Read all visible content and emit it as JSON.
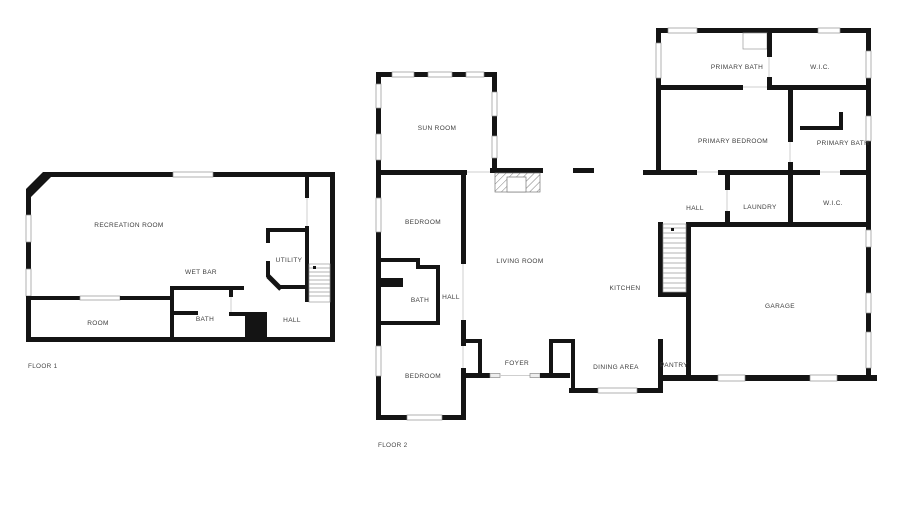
{
  "title": "Two floor residential floor plan",
  "colors": {
    "wall": "#141414",
    "label_text": "#3d3d3d",
    "background": "#ffffff"
  },
  "floors": [
    {
      "label": "FLOOR 1",
      "rooms": [
        {
          "name": "RECREATION ROOM"
        },
        {
          "name": "WET BAR"
        },
        {
          "name": "UTILITY"
        },
        {
          "name": "ROOM"
        },
        {
          "name": "BATH"
        },
        {
          "name": "HALL"
        }
      ]
    },
    {
      "label": "FLOOR 2",
      "rooms": [
        {
          "name": "SUN ROOM"
        },
        {
          "name": "BEDROOM"
        },
        {
          "name": "LIVING ROOM"
        },
        {
          "name": "BATH"
        },
        {
          "name": "HALL"
        },
        {
          "name": "BEDROOM"
        },
        {
          "name": "FOYER"
        },
        {
          "name": "KITCHEN"
        },
        {
          "name": "DINING AREA"
        },
        {
          "name": "PANTRY"
        },
        {
          "name": "HALL"
        },
        {
          "name": "LAUNDRY"
        },
        {
          "name": "W.I.C."
        },
        {
          "name": "PRIMARY BATH"
        },
        {
          "name": "W.I.C."
        },
        {
          "name": "PRIMARY BEDROOM"
        },
        {
          "name": "PRIMARY BATH"
        },
        {
          "name": "GARAGE"
        }
      ]
    }
  ]
}
